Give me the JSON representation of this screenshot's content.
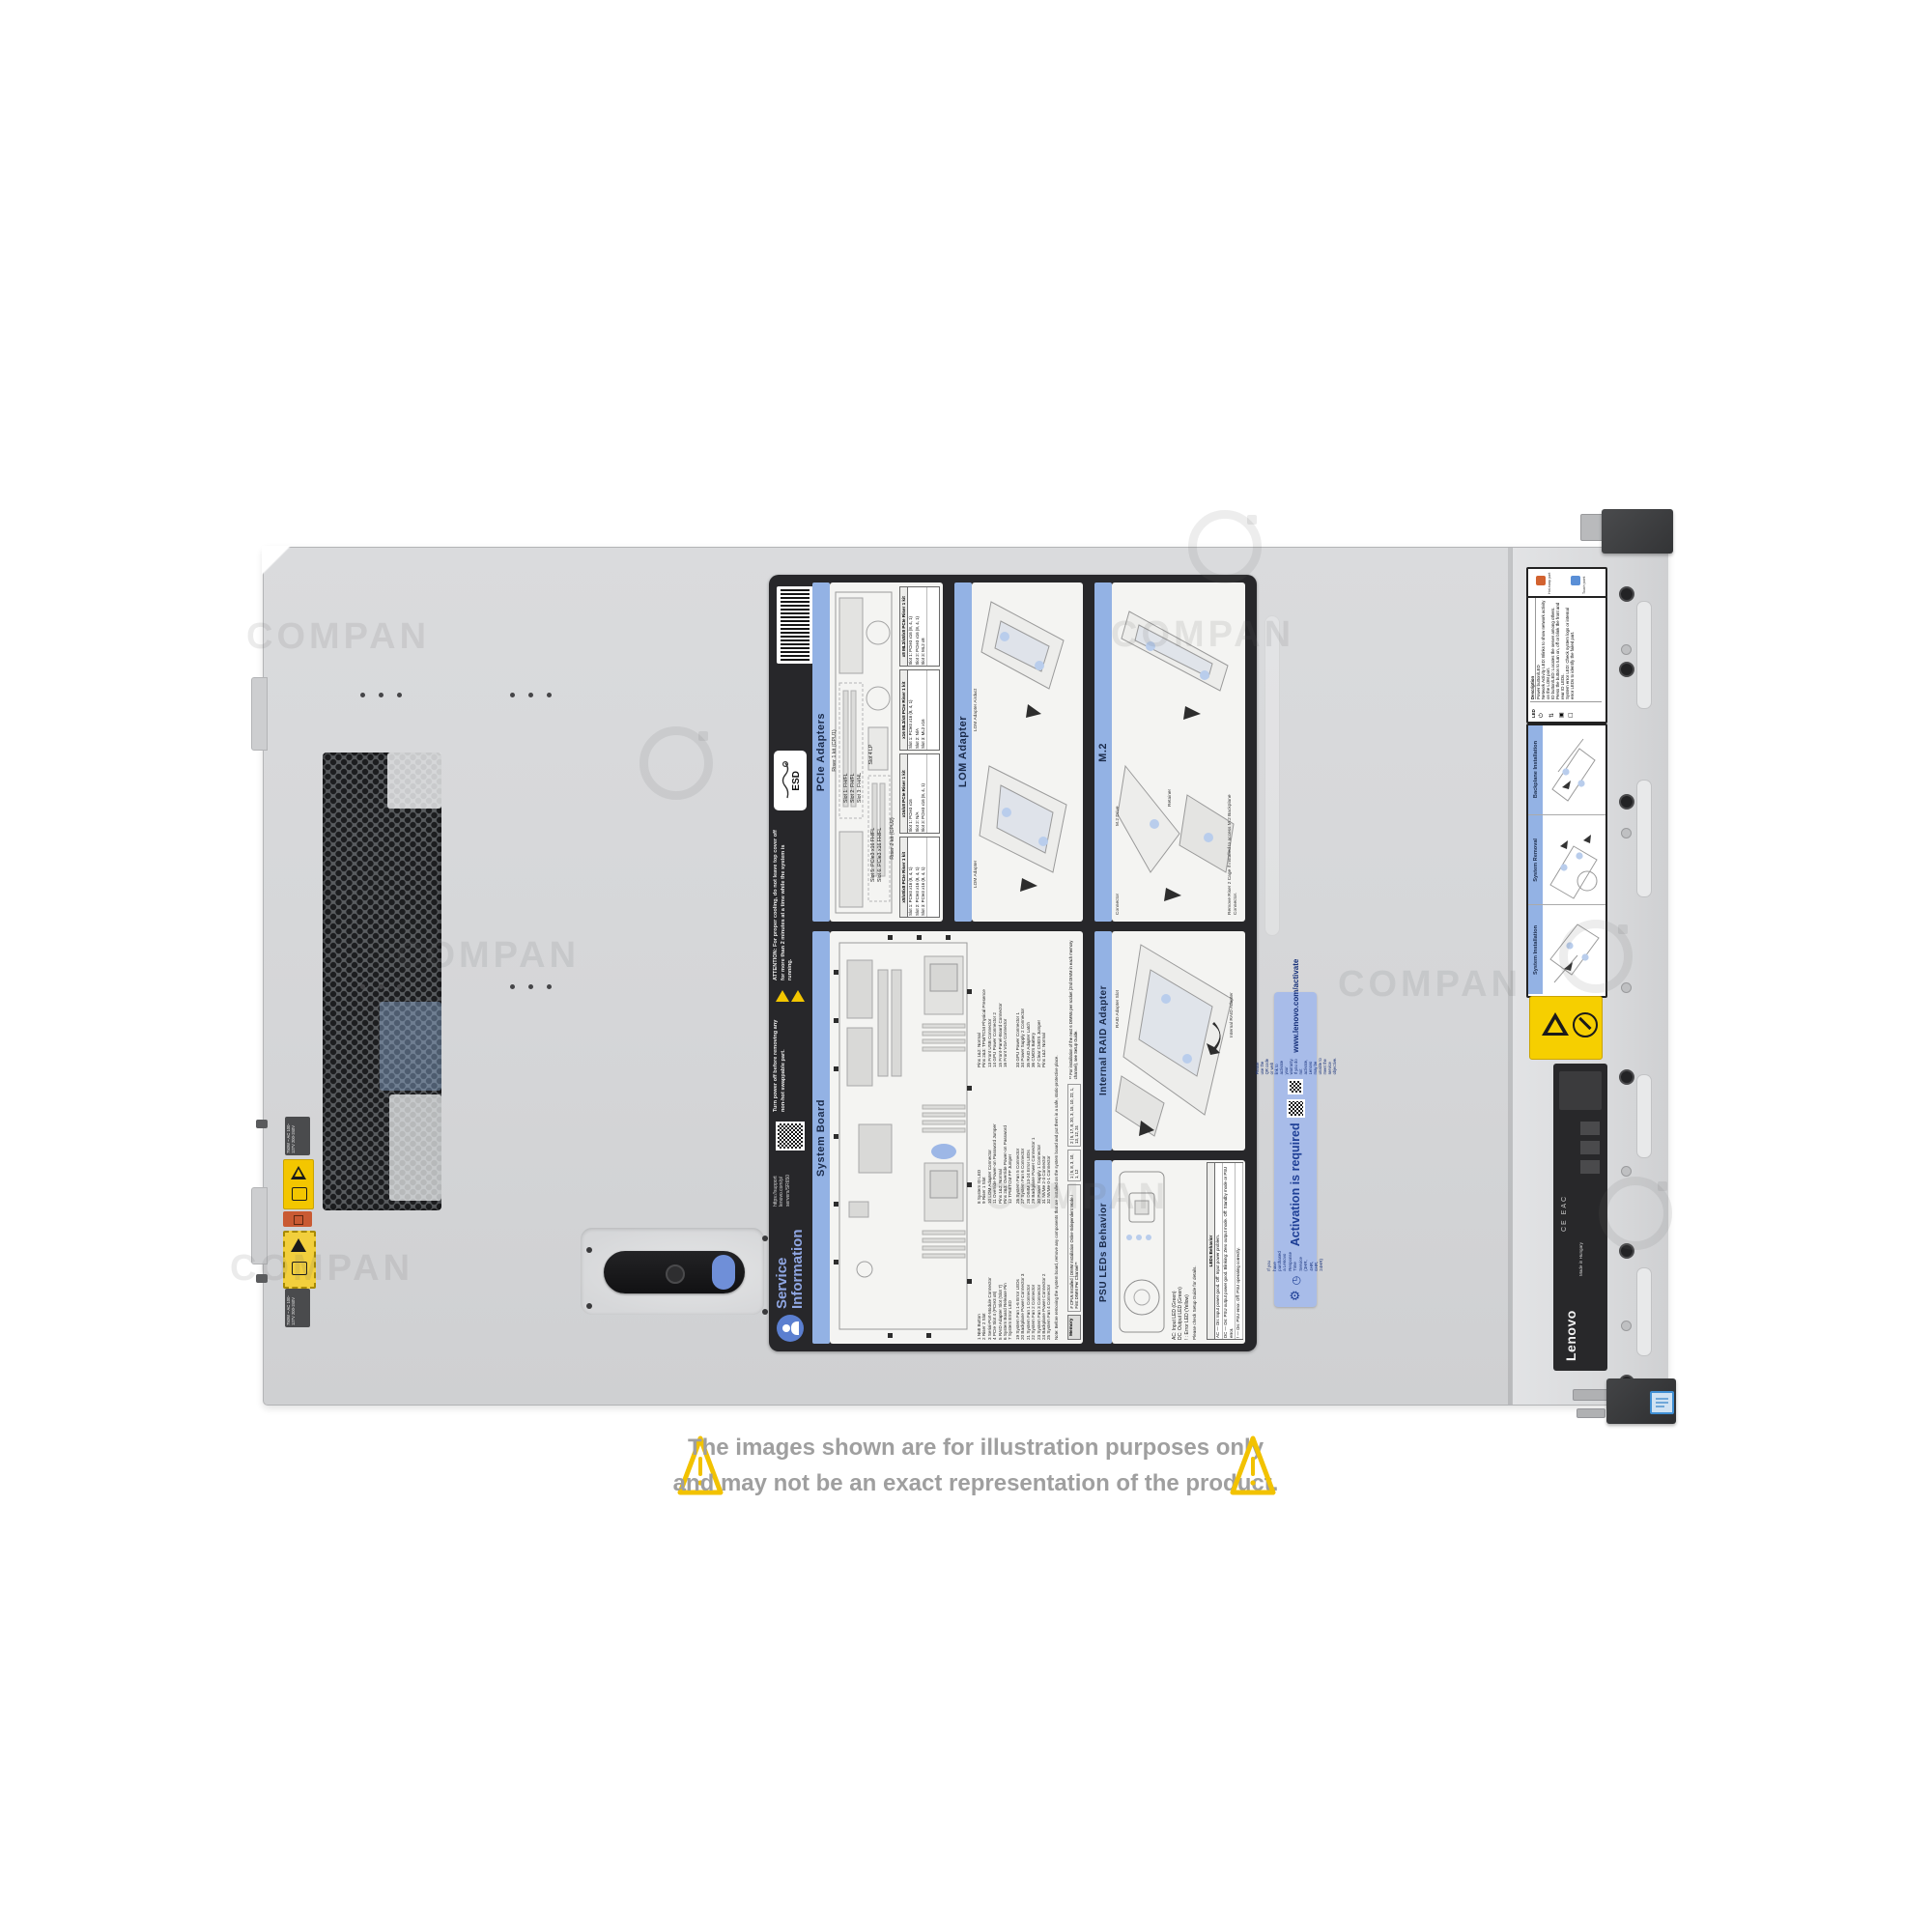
{
  "disclaimer": {
    "line1": "The images shown are for illustration purposes only",
    "line2": "and may not be an exact representation of the product."
  },
  "watermark": {
    "text": "COMPAN"
  },
  "icons": {
    "gear": "⚙",
    "clock": "◷",
    "warning": "⚠",
    "no_stack": "⃠",
    "power": "⏻",
    "network": "⇅",
    "id": "▣",
    "error": "☐"
  },
  "chassis": {
    "psu_spec": "750W ~ AC 100-127V 200-240V"
  },
  "service_label": {
    "title_line1": "Service",
    "title_line2": "Information",
    "support_url_lines": "https://support\nlenovo.com/p/\nservers/SR650",
    "esd_label": "ESD",
    "attention_note": "ATTENTION: For proper cooling, do not leave top cover off for more than 2 minutes at a time while the system is running.",
    "power_off_note": "Turn power off before removing any non-hot swappable part.",
    "sections": {
      "pcie": {
        "title": "PCIe Adapters",
        "riser1_caption": "Riser 1 kit (CPU1)",
        "riser2_caption": "Riser 2 kit (CPU2)",
        "riser1_slots": "Slot 1: FH/FL\nSlot 2: FH/FL\nSlot 3: FH/HL",
        "riser2_slots": "Slot 5: PCIe3 x16 FH/FL\nSlot 6: PCIe3 x16 FH/FL",
        "slot4": "Slot 4 LP",
        "tables": [
          {
            "title": "x8/x8/x8 PCIe Riser 1 kit",
            "rows": "Slot 1: PCIe3 x16 (8, 4, 1)\nSlot 2: PCIe3 x16 (8, 4, 1)\nSlot 3: PCIe3 x16 (8, 4, 1)"
          },
          {
            "title": "x16/x8 PCIe Riser 1 kit",
            "rows": "Slot 1: PCIe3 x16\nSlot 2: N/A\nSlot 3: PCIe3 x16 (8, 4, 1)"
          },
          {
            "title": "x16 ML2/x8 PCIe Riser 1 kit",
            "rows": "Slot 1: PCIe3 x16 (8, 4, 1)\nSlot 2: N/A\nSlot 3: ML2 x16"
          },
          {
            "title": "x8 ML2/x8/x8 PCIe Riser 1 kit",
            "rows": "Slot 1: PCIe3 x16 (8, 4, 1)\nSlot 2: PCIe3 x16 (8, 4, 1)\nSlot 3: ML2 x8"
          }
        ]
      },
      "lom": {
        "title": "LOM Adapter",
        "airduct_label": "LOM Adapter Airduct",
        "adapter_label": "LOM Adapter"
      },
      "m2": {
        "title": "M.2",
        "drive_label": "M.2 Drive",
        "connector_label": "Connector",
        "retainer_label": "Retainer",
        "note": "Remove Riser 2 Cage if installed to access M.2 Backplane Connector."
      },
      "system_board": {
        "title": "System Board",
        "legend_col1": "1 NMI Button\n2 Riser 2 Slot\n3 Serial-Port-Module Connector\n4 PCIe Slot 4 (PCIe3 x8)\n5 RAID Adapter Slot (Slot 7)\n6 System Board Release Pin\n7 System Error LED\n8 System ID LED\n9 Riser 1 Slot\n10 LOM Adapter Connector\n11 Override Power-on Password Jumper\nPins 1&2: Normal\nPins 2&3: Override Power-on Password\n12 TPM/TCM PP Jumper\nPins 1&2: Normal\nPins 2&3: TPM/TCM Physical Presence\n13 Front USB Connector\n14 GPU Power Connector 2\n15 Front-Panel-Board Connector\n16 Front VGA Connector\n17 DIMM 1-12 Error LEDs\n18 System Board Lifting Handle",
        "legend_col2": "19 System Fan 1-6 Error LEDs\n20 Backplane Power Connector 3\n21 System Fan 1 Connector\n22 System Fan 2 Connector\n23 System Fan 3 Connector\n24 Backplane Power Connector 2\n25 System Fan 4 Connector\n26 System Fan 5 Connector\n27 System Fan 6 Connector\n28 DIMM 13-24 Error LEDs\n29 Backplane Power Connector 1\n30 Power Supply 1 Connector\n31 NVMe 2-3 Connector\n32 NVMe 0-1 Connector\n33 GPU Power Connector 1\n34 Power Supply 2 Connector\n35 RAID Adapter Latch\n36 CMOS Battery\n37 Clear CMOS Jumper\nPins 1&2: Normal\nPins 2&3: Clear CMOS\n38 M.2 Backplane Connector (SATA/PCIe Slot 8)",
        "note": "Note: Before removing the system board, remove any components that are installed on the system board and put them in a safe, static-protective place.",
        "memory": {
          "title": "Memory",
          "header": "# CPUs Installed | DIMM Installation Order-Independent Mode / First DIMM Per Channel**",
          "row1": "1 | 5, 8, 3, 10, 1, 12",
          "row2": "2 | 5, 17, 8, 20, 3, 15, 10, 22, 1, 13, 12, 24",
          "footnote": "** For installation of the next 6 DIMMs per socket (2nd DIMM in each memory channel), see Setup Guide."
        }
      },
      "raid": {
        "title": "Internal RAID Adapter",
        "slot_label": "RAID Adapter Slot",
        "adapter_label": "Internal RAID Adapter"
      },
      "psu": {
        "title": "PSU LEDs Behavior",
        "legend": "AC: Input LED (Green)\nDC: Output LED (Green)\n! : Error LED (Yellow)",
        "hint": "Please check Setup Guide for details.",
        "table_title": "LEDs Behavior",
        "row_ac": "AC — On: Input power good. Off: Input power problem.",
        "row_dc": "DC — On: PSU output power good. Blinking: Zero output mode. Off: Standby mode or PSU error.",
        "row_err": "! — On: PSU error. Off: PSU operating correctly."
      }
    }
  },
  "activation_label": {
    "intro": "If you have purchased a Lenovo Response Time Service (3HR, 4HR, 6HR, 24HR)",
    "title": "Activation is required",
    "instruction": "Please use the QR code or web link to activate your warranty. If you do not activate, Lenovo may be unable to meet the service objective.",
    "url": "www.lenovo.com/activate"
  },
  "front_panel": {
    "legend": {
      "hot_swap": "Hot-swap part",
      "touch_point": "Touch point"
    },
    "led_table": {
      "col_led": "LED",
      "col_desc": "Description",
      "rows": "Power button/LED\nNetwork Activity LED: Blinks to show network activity on the LOM port.\nID button/LED: Locates the server among others. Press the button to turn on, off or blink the front and rear ID LEDs.\nSystem error LED: Check system logs or internal error LEDs to identify the failed part."
    },
    "sections": [
      {
        "title": "Backplane Installation"
      },
      {
        "title": "System Removal"
      },
      {
        "title": "System Installation"
      }
    ],
    "product_label": {
      "brand": "Lenovo",
      "origin": "Made in Hungary",
      "cert_marks": "CE  EAC"
    }
  },
  "colors": {
    "accent_blue": "#93b2e4",
    "activation_blue": "#a8bce9",
    "warning_yellow": "#f3c600",
    "hot_swap_orange": "#d2622f",
    "touch_point_blue": "#5a8fd6"
  }
}
